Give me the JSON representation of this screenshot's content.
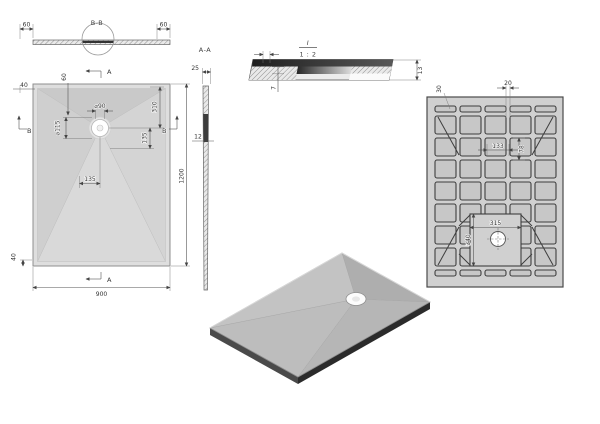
{
  "page": {
    "description": "CAD multi-view technical drawing of a rectangular shower tray",
    "background": "#ffffff"
  },
  "views": {
    "section_bb": {
      "label": "B-B",
      "dim_edge_left": "60",
      "dim_edge_right": "60"
    },
    "top_view": {
      "marker_top": "A",
      "marker_bottom": "A",
      "marker_left": "B",
      "marker_right": "B",
      "dim_left_offset": "40",
      "dim_top_offset": "60",
      "dim_drain_hole_dia": "⌀90",
      "dim_drain_recess_dia": "⌀115",
      "dim_drain_from_top": "310",
      "dim_drain_right": "135",
      "dim_drain_bottom": "135",
      "dim_bottom_offset": "40",
      "dim_overall_width": "900",
      "dim_overall_length": "1200"
    },
    "section_aa": {
      "label": "A-A",
      "dim_top_width": "25",
      "dim_thickness": "12"
    },
    "detail_i": {
      "label": "I",
      "scale": "1 : 2",
      "dim_shell": "7",
      "dim_edge_height": "13"
    },
    "bottom_view": {
      "dim_border": "30",
      "dim_rib": "20",
      "dim_pocket_width": "133",
      "dim_pocket_pitch": "78",
      "dim_recess_width": "315",
      "dim_recess_length": "340"
    }
  },
  "colors": {
    "paper": "#ffffff",
    "tray_fill": "#d8d8d8",
    "tray_shadow": "#c7c7c7",
    "outline": "#555555",
    "dim_text": "#333333",
    "section_dark": "#3a3a3a",
    "iso_top": "#bcbcbc",
    "iso_side": "#2f2f2f",
    "drain": "#ffffff"
  }
}
